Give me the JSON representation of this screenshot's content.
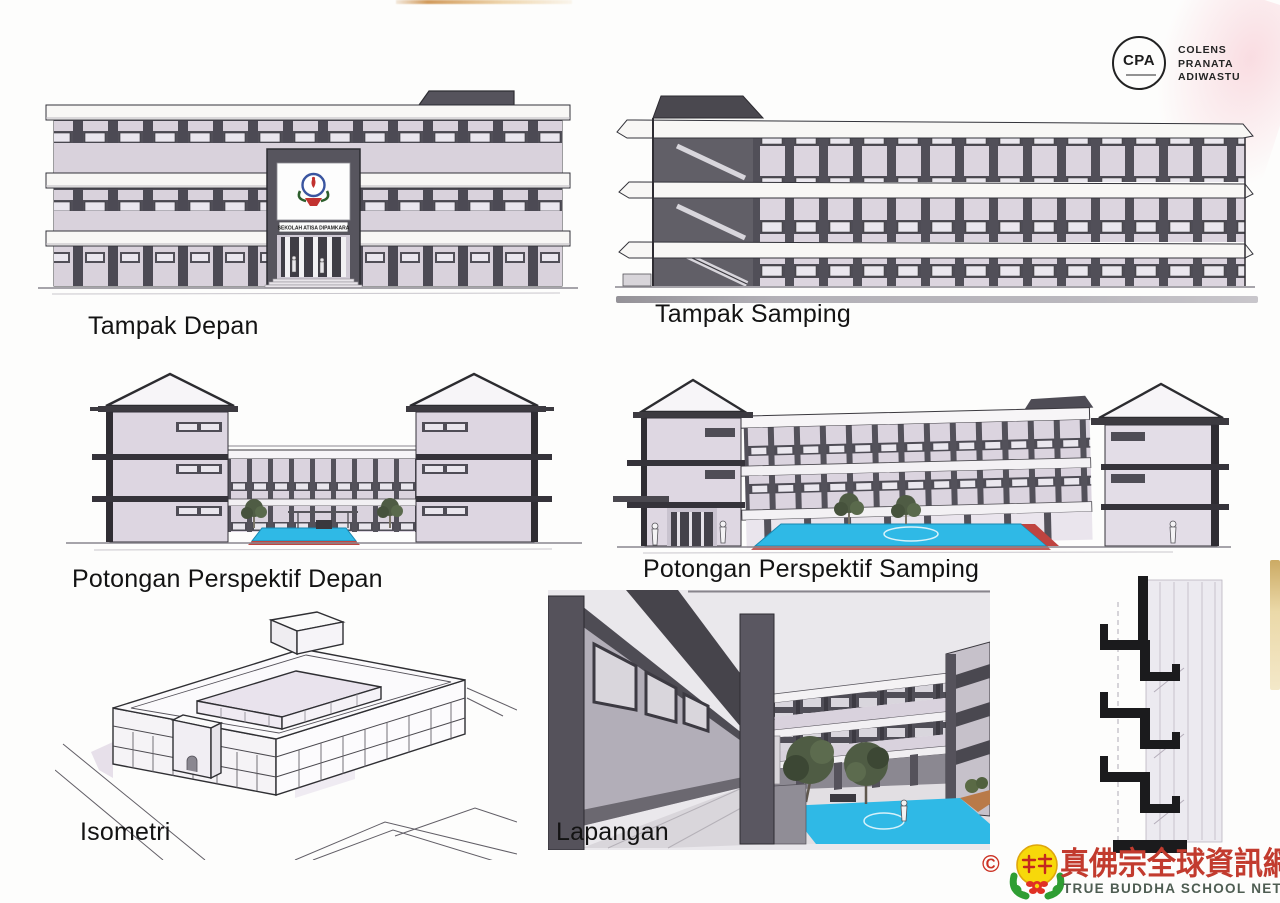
{
  "sheet": {
    "type": "architectural presentation scan"
  },
  "branding": {
    "cpa_initials": "CPA",
    "firm_lines": [
      "COLENS",
      "PRANATA",
      "ADIWASTU"
    ]
  },
  "building": {
    "school_name": "SEKOLAH ATISA DIPAMKARA"
  },
  "drawings": {
    "tampak_depan": {
      "label": "Tampak Depan"
    },
    "tampak_samping": {
      "label": "Tampak Samping"
    },
    "potongan_depan": {
      "label": "Potongan Perspektif Depan"
    },
    "potongan_samping": {
      "label": "Potongan Perspektif Samping"
    },
    "isometri": {
      "label": "Isometri"
    },
    "lapangan": {
      "label": "Lapangan"
    }
  },
  "watermark": {
    "copyright": "©",
    "chinese": "真佛宗全球資訊網",
    "english": "TRUE BUDDHA SCHOOL NET"
  },
  "colors": {
    "paper": "#fdfdfc",
    "line_dark": "#2c2c31",
    "column_gray": "#514f58",
    "wall_lavender": "#d9d2dc",
    "slab_white": "#f8f7f5",
    "court_blue": "#2fb9e6",
    "court_red": "#c04540",
    "tree_green": "#4f5c44",
    "watermark_red": "#c23b2e",
    "watermark_text_green": "#4e5d52",
    "badge_yellow": "#f7d80a",
    "badge_green": "#2f9e33"
  }
}
